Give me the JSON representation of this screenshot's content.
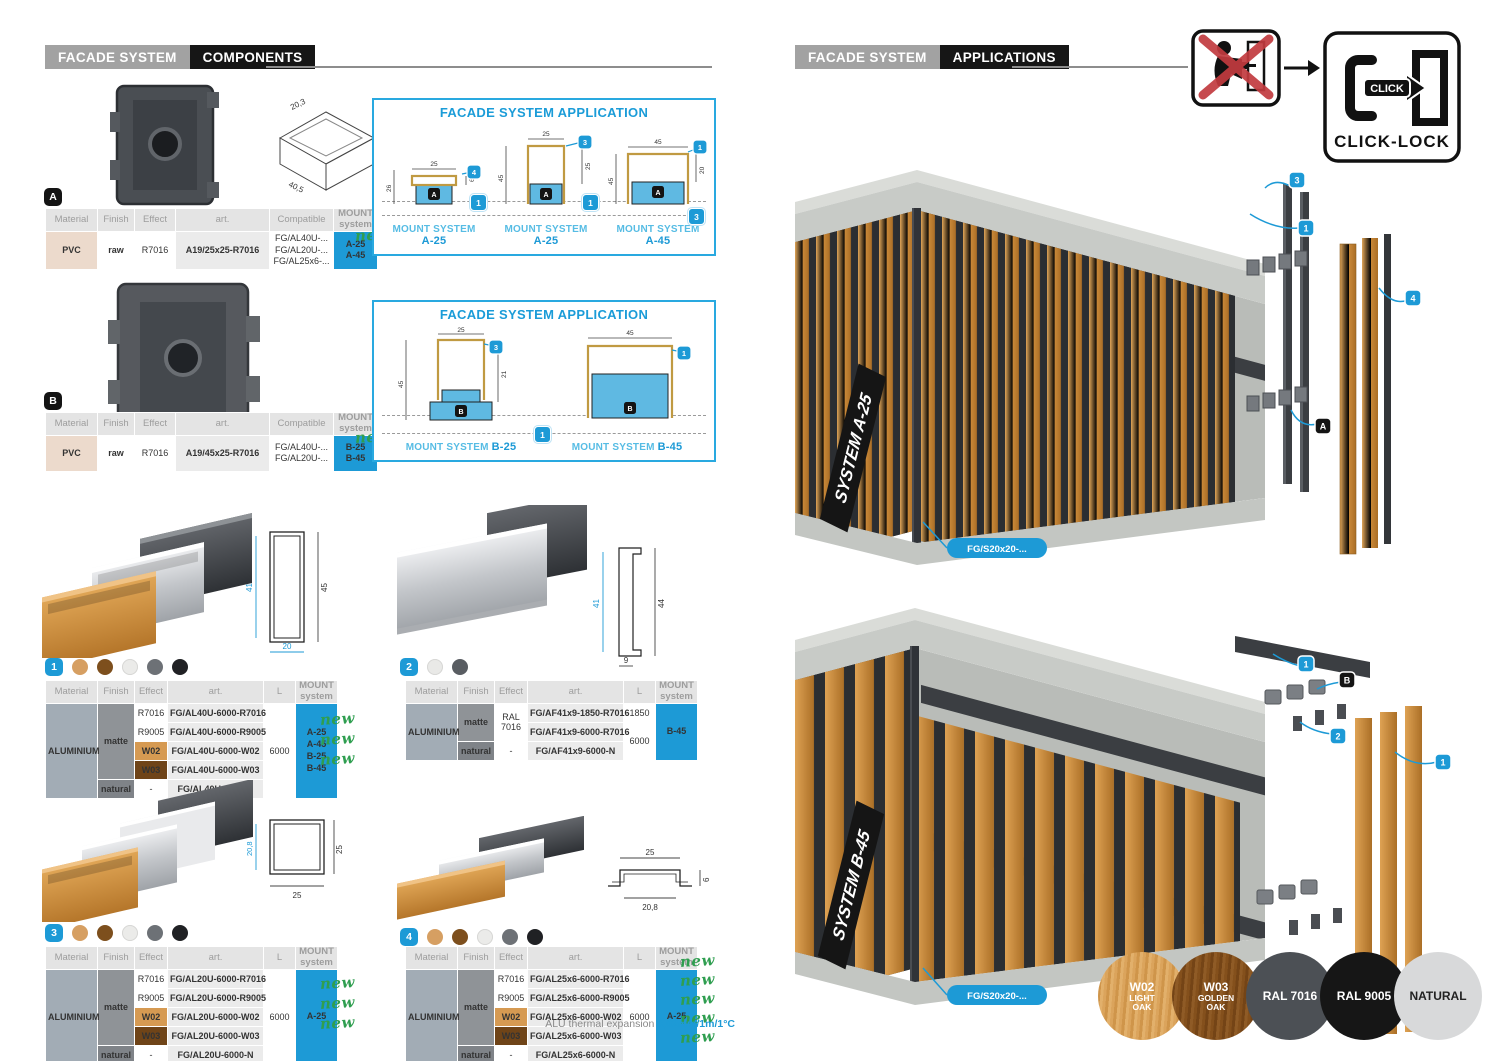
{
  "colors": {
    "accent_blue": "#1d9ad6",
    "light_blue": "#56bce4",
    "green_new": "#2f9e50",
    "mount_header_grey": "#55575b",
    "wood_light": "#d0903f",
    "wood_dark": "#7d4f1d",
    "concrete": "#c7cac6",
    "rail_dark": "#35383c"
  },
  "hdr_l": {
    "brand": "FACADE SYSTEM",
    "section": "COMPONENTS"
  },
  "hdr_r": {
    "brand": "FACADE SYSTEM",
    "section": "APPLICATIONS"
  },
  "th": {
    "material": "Material",
    "finish": "Finish",
    "effect": "Effect",
    "art": "art.",
    "compatible": "Compatible",
    "length": "L",
    "mount1": "MOUNT",
    "mount2": "system"
  },
  "labels": {
    "new": "new",
    "app_title": "FACADE SYSTEM APPLICATION",
    "mount_system": "MOUNT SYSTEM",
    "click": "CLICK",
    "click_lock": "CLICK-LOCK",
    "alu_note": "ALU thermal expansion ",
    "alu_value": "0,02mm/1m/1°C"
  },
  "comp_a": {
    "badge": "A",
    "dim1": "20,3",
    "dim2": "40,5",
    "dim3": "15,1",
    "material": "PVC",
    "finish": "raw",
    "effect": "R7016",
    "art": "A19/25x25-R7016",
    "comp1": "FG/AL40U-...",
    "comp2": "FG/AL20U-...",
    "comp3": "FG/AL25x6-...",
    "mount1": "A-25",
    "mount2": "A-45"
  },
  "comp_b": {
    "badge": "B",
    "dim1": "20",
    "dim2": "40,5",
    "dim3": "21,2",
    "dim4": "40,5",
    "dim5": "40,5",
    "material": "PVC",
    "finish": "raw",
    "effect": "R7016",
    "art": "A19/45x25-R7016",
    "comp1": "FG/AL40U-...",
    "comp2": "FG/AL20U-...",
    "mount1": "B-25",
    "mount2": "B-45"
  },
  "app_a": {
    "d": [
      {
        "system": "A-25",
        "left": "26",
        "top": "25",
        "right": "6",
        "co_top": "4",
        "badge": "A",
        "co_bottom": "1"
      },
      {
        "system": "A-25",
        "left": "45",
        "top": "25",
        "right": "25",
        "co_top": "3",
        "badge": "A",
        "co_bottom": "1"
      },
      {
        "system": "A-45",
        "left": "45",
        "top": "45",
        "right": "20",
        "co_top": "1",
        "badge": "A",
        "co_bottom": "3"
      }
    ]
  },
  "app_b": {
    "d": [
      {
        "system": "B-25",
        "left": "45",
        "top": "25",
        "right": "21",
        "co_top": "3",
        "badge": "B"
      },
      {
        "system": "B-45",
        "top": "45",
        "co_top": "1",
        "badge": "B"
      }
    ],
    "co_bottom": "1"
  },
  "p1": {
    "num": "1",
    "dim_left": "41",
    "dim_right": "45",
    "dim_bottom": "20",
    "material": "ALUMINIUM",
    "matte": "matte",
    "natural": "natural",
    "e1": "R7016",
    "e2": "R9005",
    "e3": "W02",
    "e4": "W03",
    "e5": "-",
    "a1": "FG/AL40U-6000-R7016",
    "a2": "FG/AL40U-6000-R9005",
    "a3": "FG/AL40U-6000-W02",
    "a4": "FG/AL40U-6000-W03",
    "a5": "FG/AL40U-6000-N",
    "len": "6000",
    "m1": "A-25",
    "m2": "A-45",
    "m3": "B-25",
    "m4": "B-45"
  },
  "p2": {
    "num": "2",
    "dim_left": "41",
    "dim_right": "44",
    "dim_bottom": "9",
    "material": "ALUMINIUM",
    "matte": "matte",
    "natural": "natural",
    "e1": "RAL 7016",
    "e2": "-",
    "a1": "FG/AF41x9-1850-R7016",
    "a2": "FG/AF41x9-6000-R7016",
    "a3": "FG/AF41x9-6000-N",
    "len1": "1850",
    "len2": "6000",
    "m1": "B-45"
  },
  "p3": {
    "num": "3",
    "dim_left": "20,8",
    "dim_right": "25",
    "dim_bottom": "25",
    "material": "ALUMINIUM",
    "matte": "matte",
    "natural": "natural",
    "e1": "R7016",
    "e2": "R9005",
    "e3": "W02",
    "e4": "W03",
    "e5": "-",
    "a1": "FG/AL20U-6000-R7016",
    "a2": "FG/AL20U-6000-R9005",
    "a3": "FG/AL20U-6000-W02",
    "a4": "FG/AL20U-6000-W03",
    "a5": "FG/AL20U-6000-N",
    "len": "6000",
    "m1": "A-25"
  },
  "p4": {
    "num": "4",
    "dim_top": "25",
    "dim_bottom": "20,8",
    "dim_right": "6",
    "material": "ALUMINIUM",
    "matte": "matte",
    "natural": "natural",
    "e1": "R7016",
    "e2": "R9005",
    "e3": "W02",
    "e4": "W03",
    "e5": "-",
    "a1": "FG/AL25x6-6000-R7016",
    "a2": "FG/AL25x6-6000-R9005",
    "a3": "FG/AL25x6-6000-W02",
    "a4": "FG/AL25x6-6000-W03",
    "a5": "FG/AL25x6-6000-N",
    "len": "6000",
    "m1": "A-25"
  },
  "render_a": {
    "system": "SYSTEM A-25",
    "part": "FG/S20x20-...",
    "co3": "3",
    "co1": "1",
    "co4": "4",
    "badge": "A"
  },
  "render_b": {
    "system": "SYSTEM B-45",
    "part": "FG/S20x20-...",
    "co1a": "1",
    "badge": "B",
    "co2": "2",
    "co1b": "1"
  },
  "swatches": [
    {
      "code": "W02",
      "name": "LIGHT\nOAK",
      "color": "#d89c4e"
    },
    {
      "code": "W03",
      "name": "GOLDEN\nOAK",
      "color": "#7d4f1d"
    },
    {
      "code": "RAL 7016",
      "name": "",
      "color": "#4c5055"
    },
    {
      "code": "RAL 9005",
      "name": "",
      "color": "#161616"
    },
    {
      "code": "NATURAL",
      "name": "",
      "color": "#d8d9da"
    }
  ],
  "dots1": [
    "#d69f62",
    "#7d4f1d",
    "#ebebe9",
    "#6d7176",
    "#202124"
  ],
  "dots2": [
    "#e9e9e7",
    "#595d62"
  ]
}
